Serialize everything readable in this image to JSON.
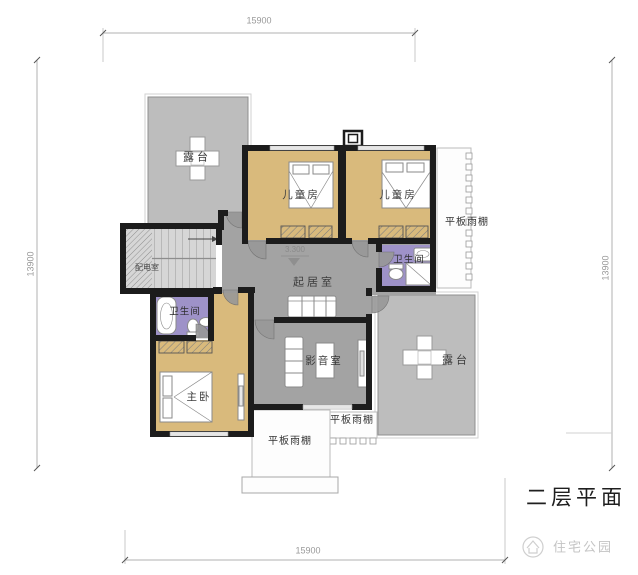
{
  "title": "二层平面",
  "brand": {
    "logo_text": "住宅公园"
  },
  "level_marker": "3.300",
  "dimensions": {
    "top": "15900",
    "bottom": "15900",
    "left": "13900",
    "right": "13900"
  },
  "labels": {
    "terrace_top_left": "露台",
    "terrace_bottom_right": "露台",
    "children_room_left": "儿童房",
    "children_room_right": "儿童房",
    "bathroom_upper": "卫生间",
    "bathroom_lower": "卫生间",
    "living_room": "起居室",
    "media_room": "影音室",
    "master_bedroom": "主卧",
    "electrical_room": "配电室",
    "canopy_right": "平板雨棚",
    "canopy_bottom_right": "平板雨棚",
    "canopy_bottom_left": "平板雨棚"
  },
  "colors": {
    "wall": "#1c1c1c",
    "floor_tan": "#d9ba7c",
    "floor_purple": "#9e92c8",
    "floor_gray": "#a3a3a3",
    "terrace_gray": "#bdbdbd",
    "canopy_white": "#fdfdfd",
    "dim_line": "#b0b0b0",
    "furniture_stroke": "#8a8a8a"
  }
}
